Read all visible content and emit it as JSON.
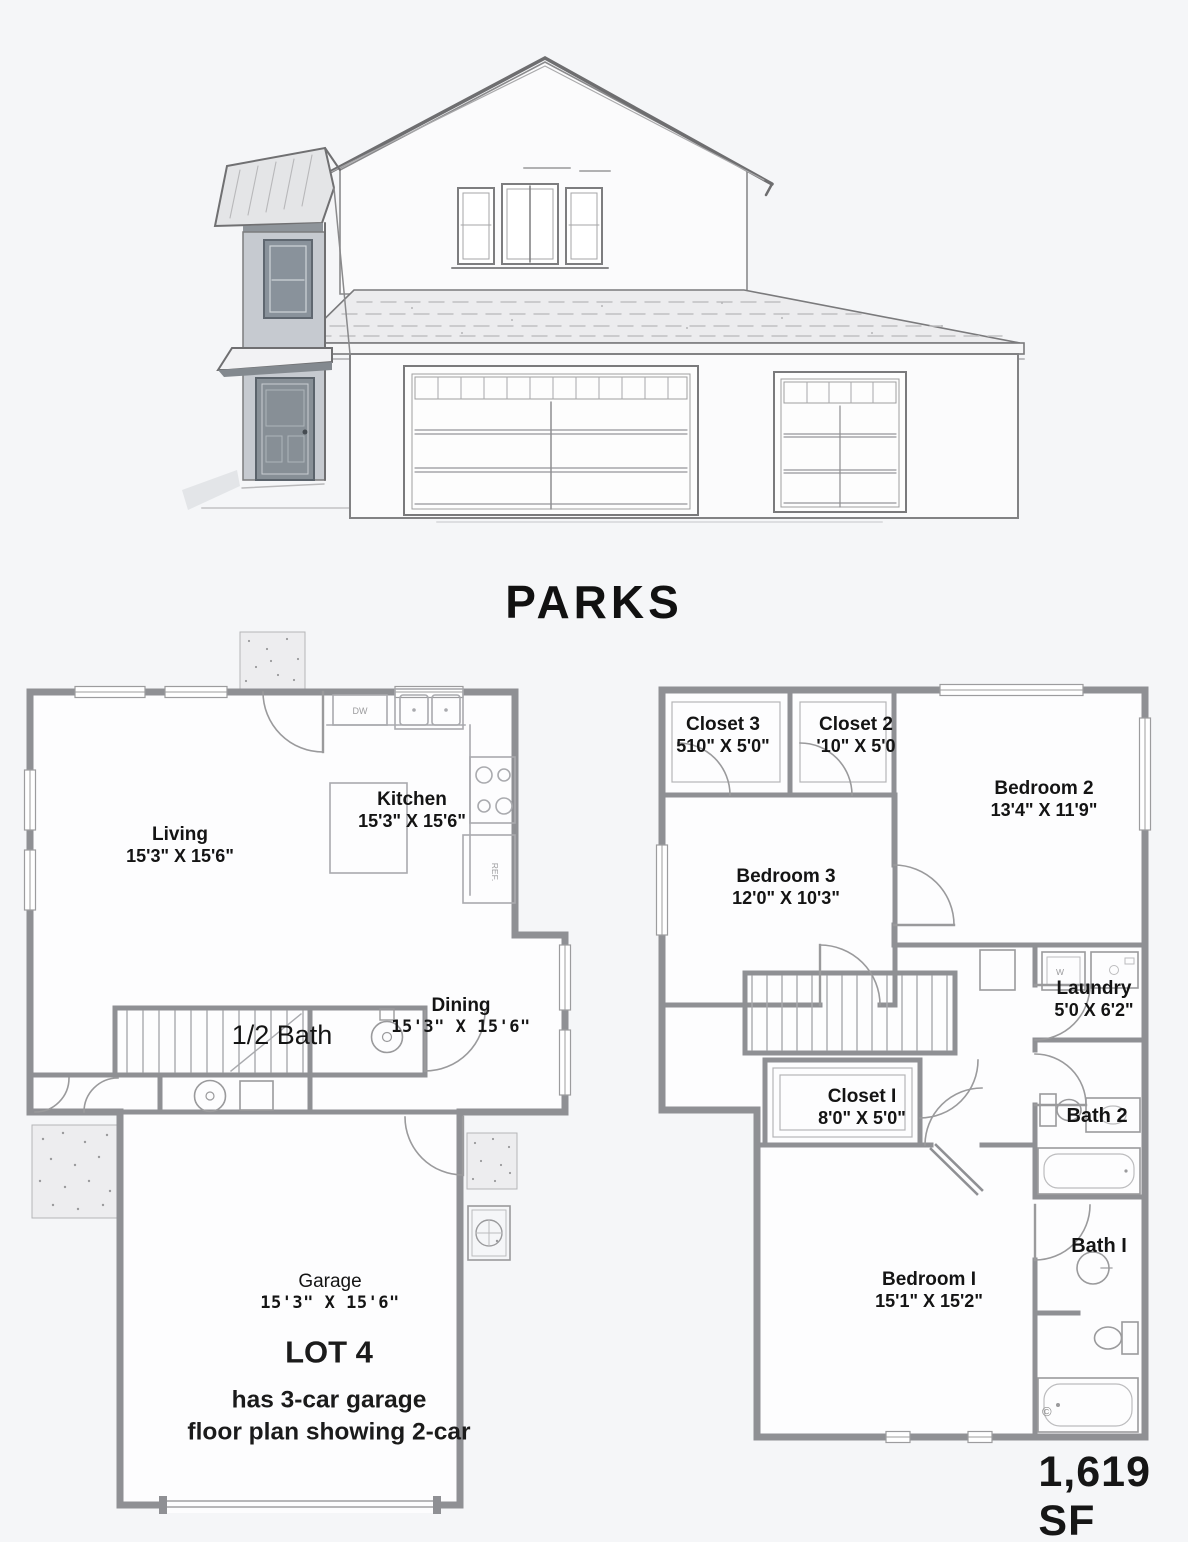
{
  "page": {
    "title": "PARKS",
    "area_label": "1,619 SF",
    "copyright_mark": "©"
  },
  "floor1": {
    "name": "main-floor",
    "rooms": [
      {
        "name": "Living",
        "dims": "15'3\" X 15'6\""
      },
      {
        "name": "Kitchen",
        "dims": "15'3\" X 15'6\""
      },
      {
        "name": "1/2 Bath",
        "dims": ""
      },
      {
        "name": "Dining",
        "dims": "15'3\" X 15'6\""
      },
      {
        "name": "Garage",
        "dims": "15'3\" X 15'6\""
      }
    ],
    "note": {
      "title": "LOT 4",
      "line1": "has 3-car garage",
      "line2": "floor plan showing 2-car"
    },
    "fixtures": {
      "dishwasher": "DW",
      "refrigerator": "REF."
    }
  },
  "floor2": {
    "name": "upper-floor",
    "rooms": [
      {
        "name": "Closet 3",
        "dims": "510\" X 5'0\""
      },
      {
        "name": "Closet 2",
        "dims": "'10\" X 5'0"
      },
      {
        "name": "Bedroom 2",
        "dims": "13'4\" X 11'9\""
      },
      {
        "name": "Bedroom 3",
        "dims": "12'0\" X 10'3\""
      },
      {
        "name": "Laundry",
        "dims": "5'0 X 6'2\""
      },
      {
        "name": "Closet I",
        "dims": "8'0\" X 5'0\""
      },
      {
        "name": "Bath 2",
        "dims": ""
      },
      {
        "name": "Bath I",
        "dims": ""
      },
      {
        "name": "Bedroom I",
        "dims": "15'1\" X 15'2\""
      }
    ],
    "fixtures": {
      "washer": "W"
    }
  },
  "colors": {
    "wall": "#8f9094",
    "thin_line": "#a9aaae",
    "text": "#141414",
    "page_bg": "#f5f6f8",
    "plan_bg": "#fdfdfe",
    "shade": "#c6cad0"
  }
}
